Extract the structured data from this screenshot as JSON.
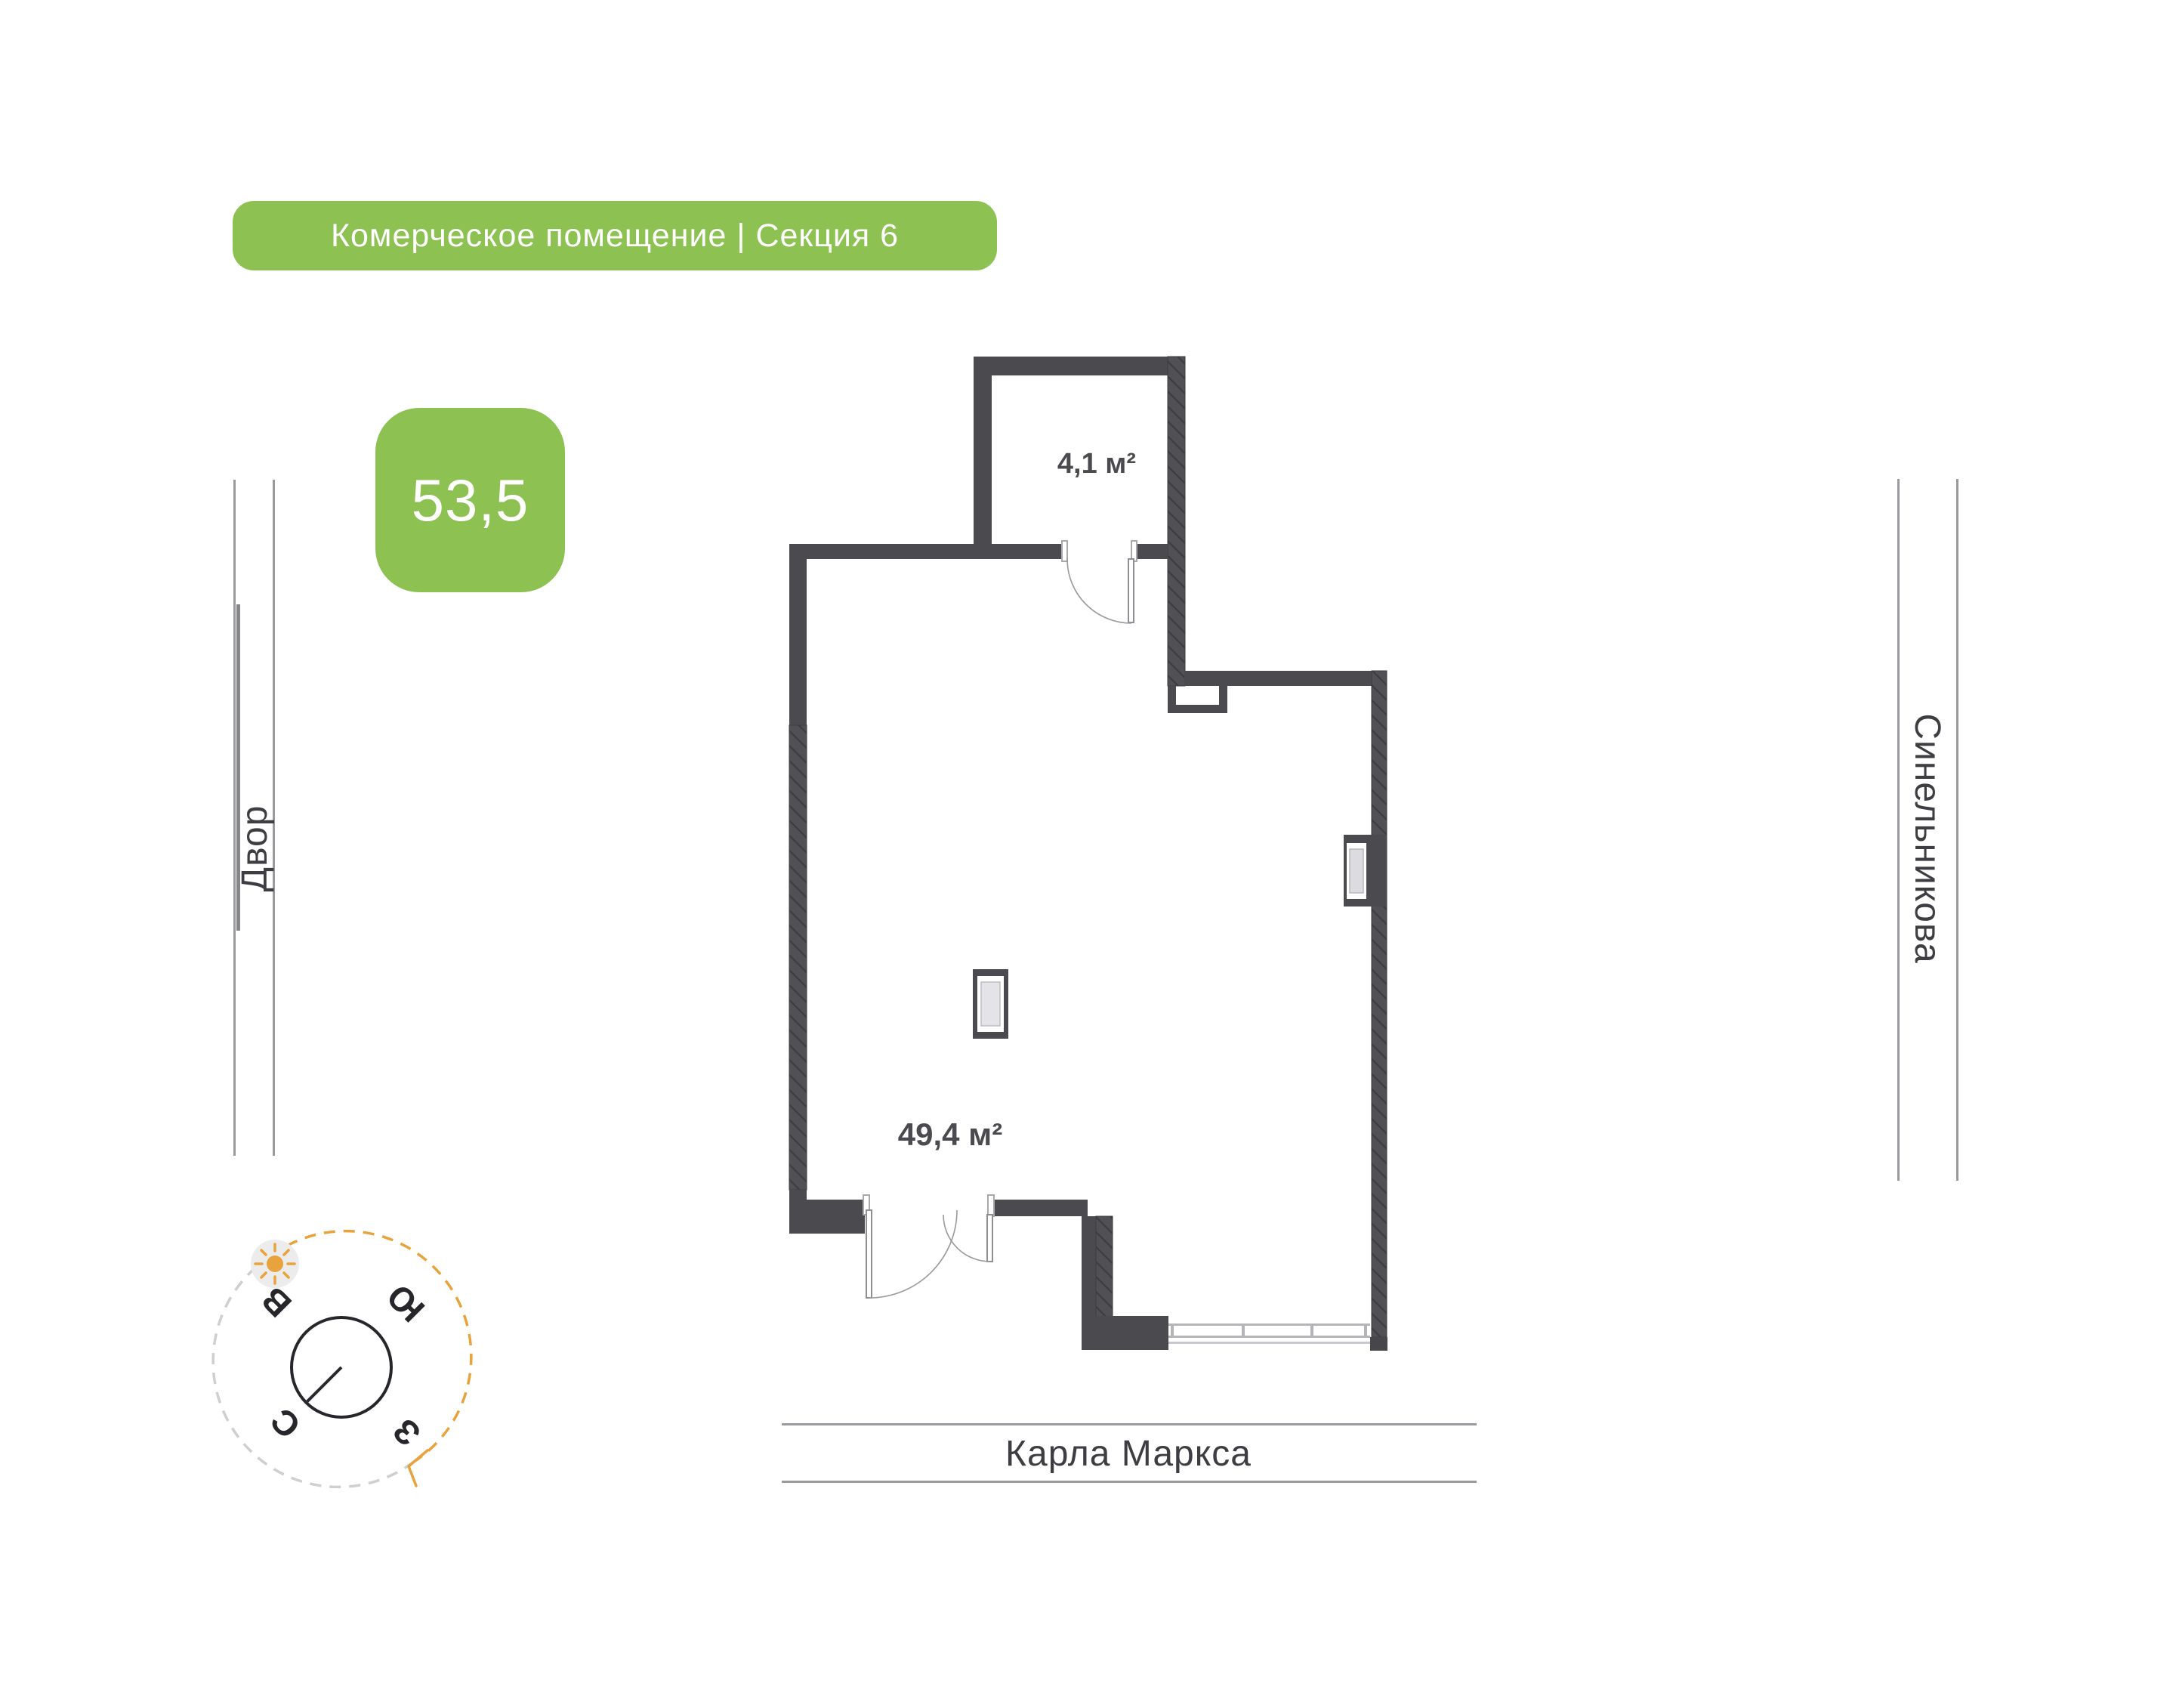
{
  "title_badge": {
    "text": "Комерческое помещение | Секция 6"
  },
  "area_badge": {
    "value": "53,5"
  },
  "floor_plan": {
    "rooms": [
      {
        "name": "storage",
        "area_label": "4,1 м²"
      },
      {
        "name": "main-hall",
        "area_label": "49,4 м²"
      }
    ]
  },
  "streets": {
    "left": "Двор",
    "right": "Синельникова",
    "bottom": "Карла Маркса"
  },
  "compass": {
    "north": "С",
    "east": "В",
    "south": "Ю",
    "west": "З",
    "rotation_deg": "225"
  },
  "colors": {
    "accent_green": "#8dc152",
    "wall": "#4a4a4f",
    "wall_hatch": "#505055",
    "street_line": "#9a9a9e",
    "street_text": "#3d3d42",
    "compass_accent": "#e8a33d"
  }
}
